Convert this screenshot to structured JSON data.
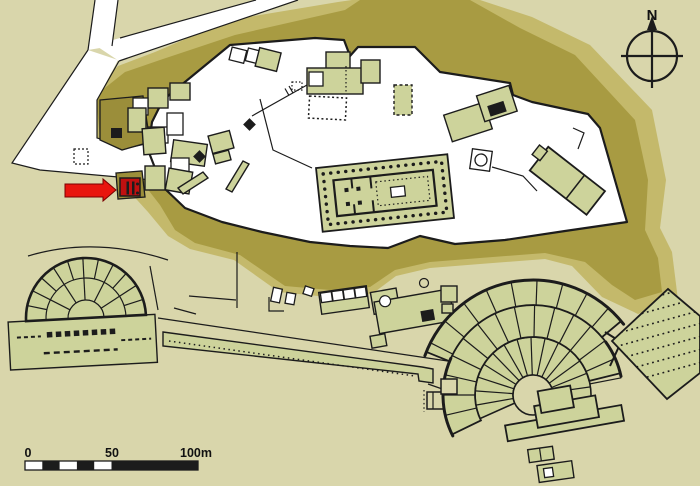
{
  "compass": {
    "label": "N"
  },
  "scale_bar": {
    "labels": [
      "0",
      "50",
      "100m"
    ]
  },
  "colors": {
    "bg": "#d9d6ab",
    "slope_light": "#c4b96b",
    "slope_dark": "#a89b42",
    "bastion": "#9b8e3a",
    "building": "#cdd39b",
    "plateau": "#ffffff",
    "line": "#1c1c1c",
    "highlight_red": "#e8150e",
    "highlight_dark_red": "#c01010"
  }
}
